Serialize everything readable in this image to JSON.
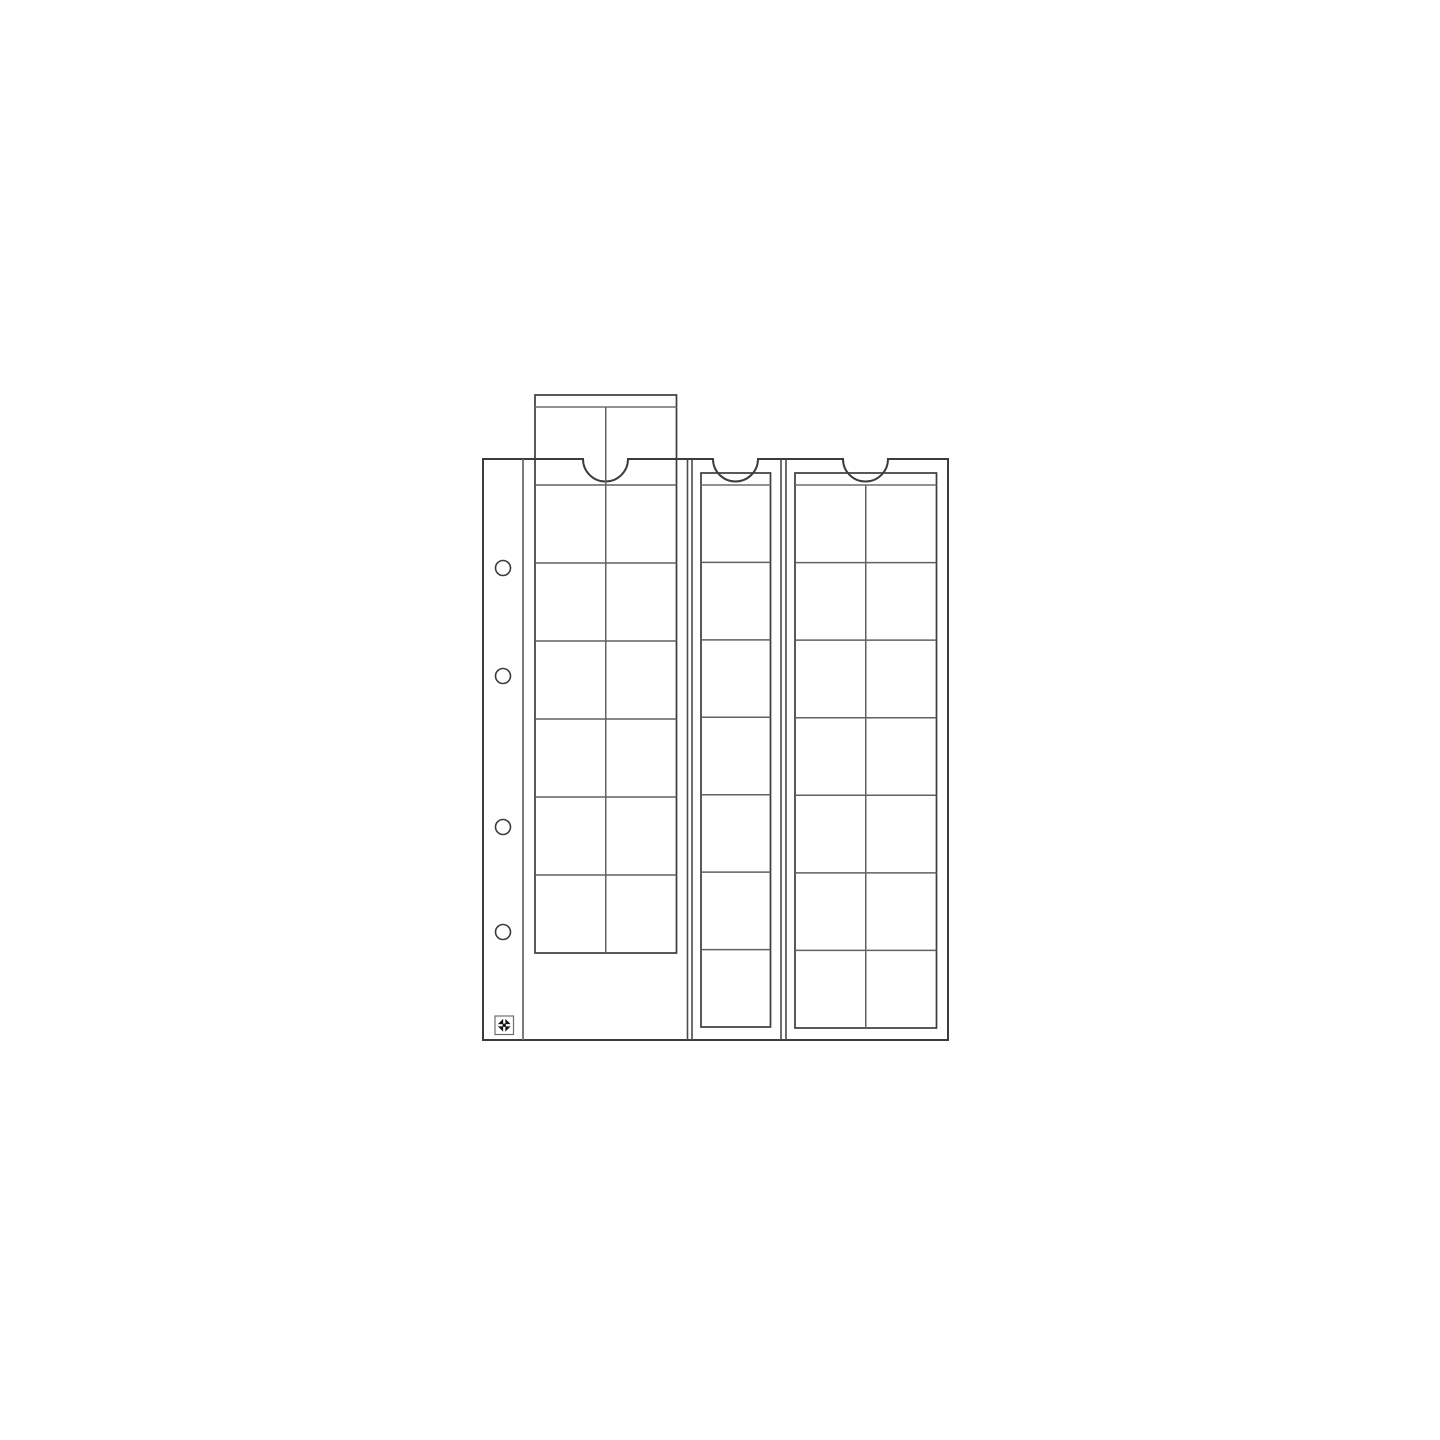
{
  "canvas": {
    "width": 1440,
    "height": 1440,
    "background": "#ffffff"
  },
  "style": {
    "outline_color": "#3c3c3c",
    "seam_color": "#4a4a4a",
    "margin_color": "#6e6e6e",
    "grid_color": "#616161",
    "band_color": "#6e6e6e",
    "hole_color": "#3c3c3c",
    "logo_border_color": "#6e6e6e",
    "logo_glyph_color": "#141414",
    "outline_width": 2,
    "strip_width": 1.7,
    "grid_width": 1.5,
    "seam_width": 1.6
  },
  "page": {
    "left": 483,
    "top": 459,
    "right": 948,
    "bottom": 1040,
    "margin_divider_x": 523,
    "seam_xs": [
      687.5,
      692,
      781,
      786
    ],
    "thumb_cuts": [
      {
        "cx": 605.5,
        "r": 22.5
      },
      {
        "cx": 735.5,
        "r": 22.5
      },
      {
        "cx": 865.5,
        "r": 22.5
      }
    ],
    "binder_holes": {
      "cx": 503,
      "r": 7.5,
      "cy_list": [
        568,
        676,
        827,
        932
      ]
    }
  },
  "strips": [
    {
      "id": "pocket-strip-left-pulled-out",
      "x1": 535,
      "x2": 676.5,
      "top": 395,
      "band_y": 407,
      "bottom": 953,
      "rows": 7,
      "cols": 2,
      "pulled_out": true
    },
    {
      "id": "pocket-strip-middle",
      "x1": 701,
      "x2": 770.5,
      "top": 473,
      "band_y": 485,
      "bottom": 1027,
      "rows": 7,
      "cols": 1,
      "pulled_out": false
    },
    {
      "id": "pocket-strip-right",
      "x1": 795,
      "x2": 936.5,
      "top": 473,
      "band_y": 485,
      "bottom": 1028,
      "rows": 7,
      "cols": 2,
      "pulled_out": false
    }
  ],
  "logo": {
    "x": 495,
    "y": 1016,
    "size": 18.5
  },
  "diagram": {
    "type": "coin-album-sheet-line-drawing",
    "label": "Coin album pocket sheet with three sliding strips, four binder holes and maker logo"
  }
}
